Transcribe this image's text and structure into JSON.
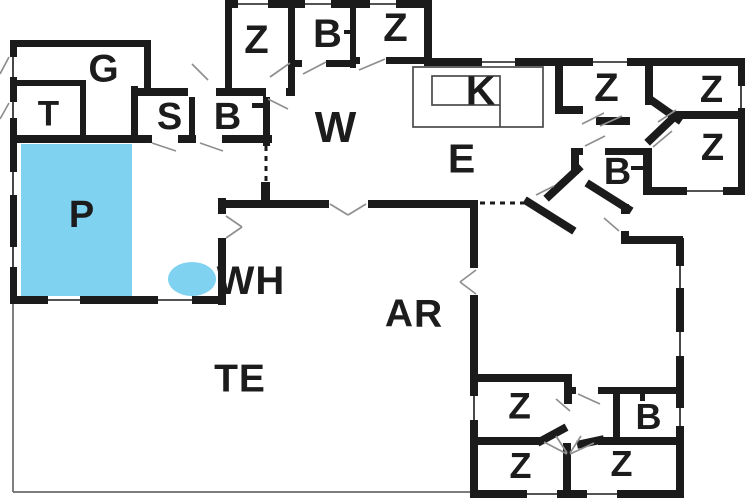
{
  "plan": {
    "type": "floor-plan",
    "colors": {
      "wall": "#1b1b1b",
      "pool": "#7fd2f0",
      "door_swing": "#8f8f8f",
      "kitchen_counter": "#4a4a4a",
      "terrace_line": "#6a6a6a",
      "label": "#1c1c1c",
      "background": "#ffffff"
    },
    "rooms": [
      {
        "id": "garage",
        "label": "G"
      },
      {
        "id": "toilet",
        "label": "T"
      },
      {
        "id": "sauna",
        "label": "S"
      },
      {
        "id": "bath-west",
        "label": "B"
      },
      {
        "id": "bedroom-top-1",
        "label": "Z"
      },
      {
        "id": "bath-top",
        "label": "B"
      },
      {
        "id": "bedroom-top-2",
        "label": "Z"
      },
      {
        "id": "living-room",
        "label": "W"
      },
      {
        "id": "kitchen",
        "label": "K"
      },
      {
        "id": "dining",
        "label": "E"
      },
      {
        "id": "bedroom-ne-1",
        "label": "Z"
      },
      {
        "id": "bedroom-ne-2",
        "label": "Z"
      },
      {
        "id": "bedroom-east",
        "label": "Z"
      },
      {
        "id": "bath-east",
        "label": "B"
      },
      {
        "id": "pool",
        "label": "P"
      },
      {
        "id": "whirlpool",
        "label": "WH"
      },
      {
        "id": "annex-area",
        "label": "AR"
      },
      {
        "id": "terrace",
        "label": "TE"
      },
      {
        "id": "bedroom-south-1",
        "label": "Z"
      },
      {
        "id": "bath-south",
        "label": "B"
      },
      {
        "id": "bedroom-south-2",
        "label": "Z"
      },
      {
        "id": "bedroom-south-3",
        "label": "Z"
      }
    ]
  }
}
